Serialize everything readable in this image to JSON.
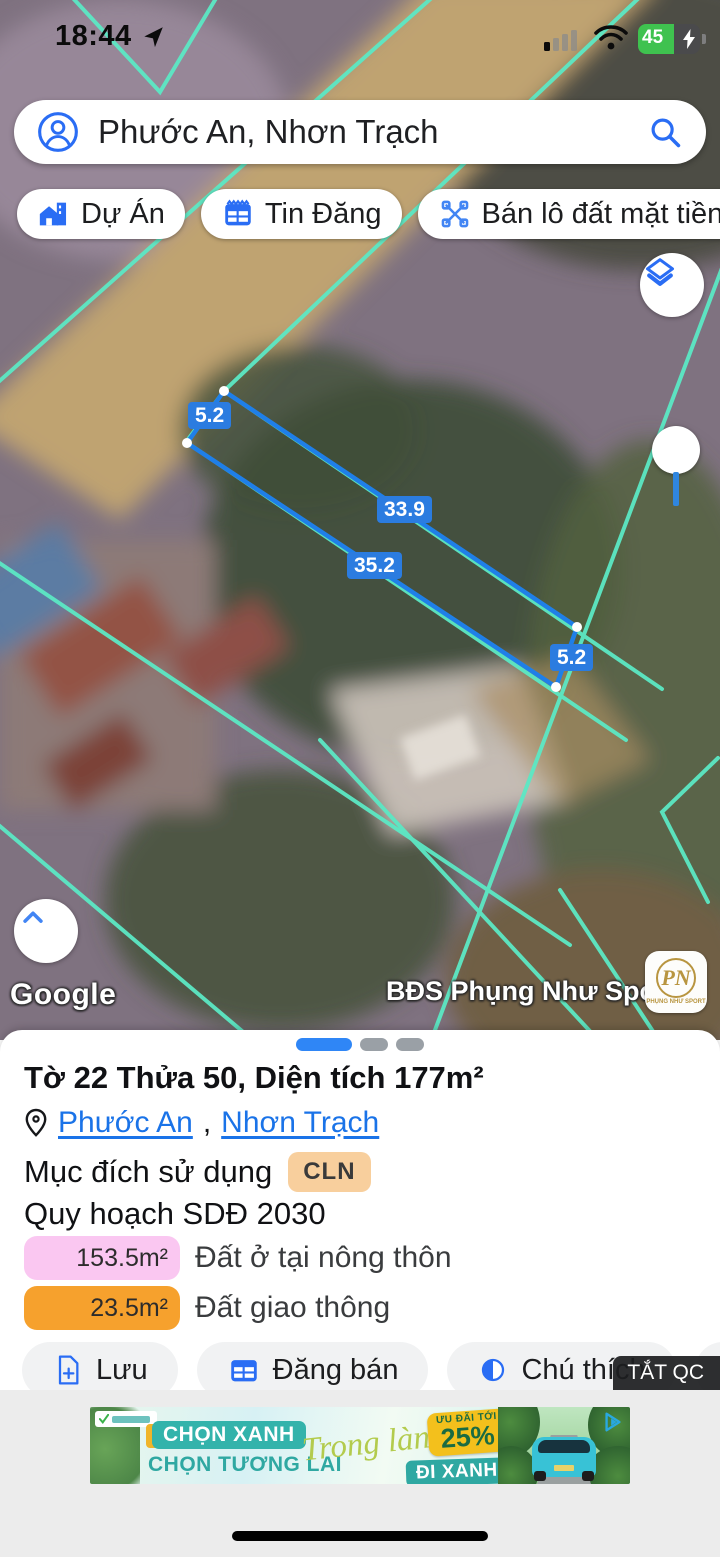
{
  "colors": {
    "accent": "#1a73e8",
    "boundary_cyan": "#5ce8c4",
    "measure_blue": "#2b7ce0",
    "zone0_bg": "#fac7f1",
    "zone1_bg": "#f6a12d",
    "purpose_badge_bg": "#f8cf9d",
    "battery_green": "#3fc24f",
    "ad_teal": "#2fa8a2",
    "ad_yellow": "#f3c01c"
  },
  "status_bar": {
    "time": "18:44",
    "battery_percent": "45"
  },
  "search": {
    "query": "Phước An, Nhơn Trạch"
  },
  "chips": [
    {
      "label": "Dự Án",
      "icon": "house-project-icon"
    },
    {
      "label": "Tin Đăng",
      "icon": "listing-table-icon"
    },
    {
      "label": "Bán lô đất mặt tiền nhựa",
      "icon": "scissors-icon"
    }
  ],
  "map": {
    "measurements": {
      "left_width": "5.2",
      "top_length": "33.9",
      "bottom_length": "35.2",
      "right_width": "5.2"
    },
    "google_watermark": "Google",
    "brand_watermark": "BĐS Phụng Như Sport",
    "brand_logo_monogram": "PN",
    "brand_logo_caption": "PHỤNG NHƯ SPORT"
  },
  "panel": {
    "title": "Tờ 22 Thửa 50, Diện tích 177m²",
    "location": {
      "links": [
        "Phước An",
        "Nhơn Trạch"
      ],
      "separator": ","
    },
    "purpose_label": "Mục đích sử dụng",
    "purpose_value": "CLN",
    "planning_label": "Quy hoạch SDĐ 2030",
    "zones": [
      {
        "area": "153.5m²",
        "label": "Đất ở tại nông thôn"
      },
      {
        "area": "23.5m²",
        "label": "Đất giao thông"
      }
    ],
    "actions": [
      {
        "label": "Lưu",
        "icon": "save-file-plus-icon"
      },
      {
        "label": "Đăng bán",
        "icon": "post-sale-table-icon"
      },
      {
        "label": "Chú thích",
        "icon": "legend-contrast-icon"
      },
      {
        "label": "C",
        "icon": "camera-plus-icon"
      }
    ],
    "dismiss_ad": "TẮT QC"
  },
  "ad": {
    "line1": "CHỌN XANH",
    "line2": "CHỌN TƯƠNG LAI",
    "script_text": "Trong lành",
    "promo_small": "ƯU ĐÃI TỚI",
    "promo_big": "25%",
    "cta": "ĐI XANH NGAY"
  }
}
